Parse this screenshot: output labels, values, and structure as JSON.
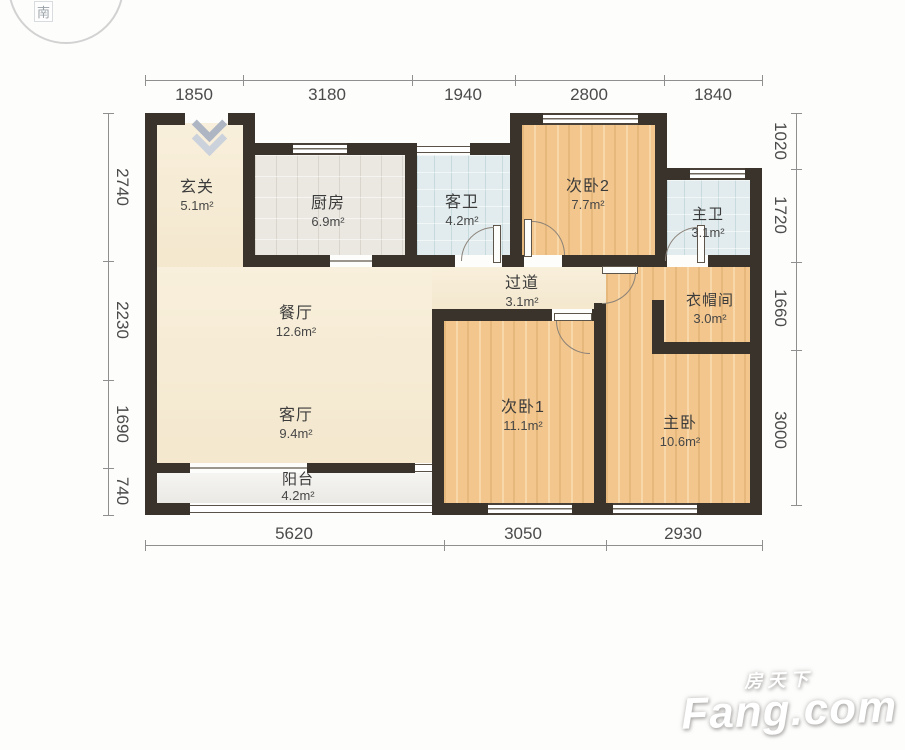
{
  "compass": {
    "south_label": "南"
  },
  "rooms": {
    "xuanguan": {
      "name": "玄关",
      "area": "5.1m²"
    },
    "chufang": {
      "name": "厨房",
      "area": "6.9m²"
    },
    "kewei": {
      "name": "客卫",
      "area": "4.2m²"
    },
    "ciwo2": {
      "name": "次卧2",
      "area": "7.7m²"
    },
    "zhuwei": {
      "name": "主卫",
      "area": "3.1m²"
    },
    "guodao": {
      "name": "过道",
      "area": "3.1m²"
    },
    "yimaojian": {
      "name": "衣帽间",
      "area": "3.0m²"
    },
    "canting": {
      "name": "餐厅",
      "area": "12.6m²"
    },
    "keting": {
      "name": "客厅",
      "area": "9.4m²"
    },
    "yangtai": {
      "name": "阳台",
      "area": "4.2m²"
    },
    "ciwo1": {
      "name": "次卧1",
      "area": "11.1m²"
    },
    "zhuwo": {
      "name": "主卧",
      "area": "10.6m²"
    }
  },
  "dimensions": {
    "top": [
      "1850",
      "3180",
      "1940",
      "2800",
      "1840"
    ],
    "left": [
      "2740",
      "2230",
      "1690",
      "740"
    ],
    "right": [
      "1020",
      "1720",
      "1660",
      "3000"
    ],
    "bottom": [
      "5620",
      "3050",
      "2930"
    ]
  },
  "watermark": {
    "brand_cn": "房天下",
    "brand_en": "Fang.com"
  },
  "colors": {
    "wall": "#3a332b",
    "wood_floor": "#f2c68c",
    "cream_floor": "#f7ecd4",
    "bath_tile": "#e2ecee",
    "kitchen_tile": "#ebe8e2",
    "balcony_floor": "#f1f0ec",
    "dimension_text": "#4b4b4b"
  }
}
